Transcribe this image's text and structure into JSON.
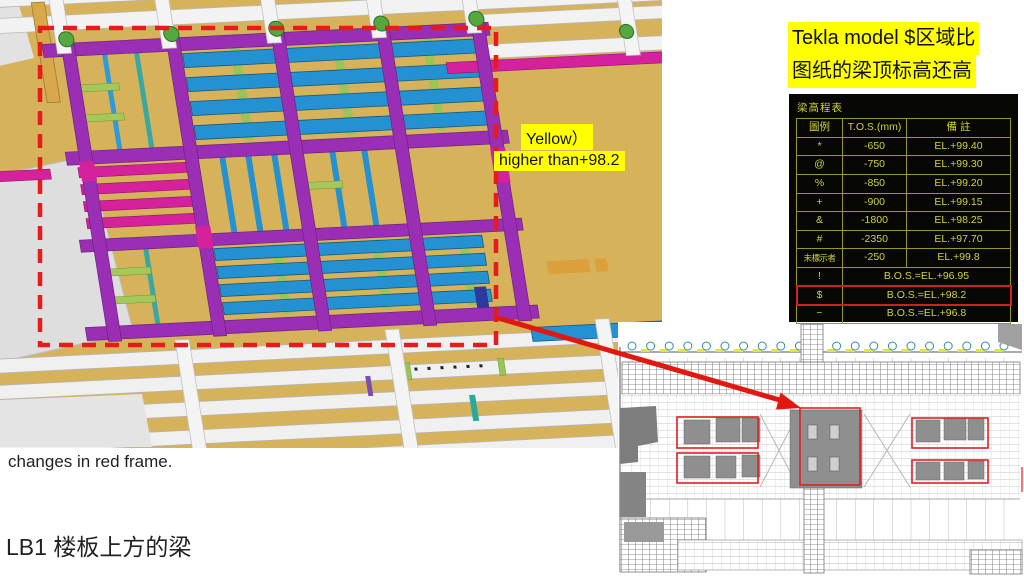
{
  "note": {
    "line1": "Tekla model $区域比",
    "line2": "图纸的梁顶标高还高"
  },
  "model_labels": {
    "yellow_label": "Yellow）",
    "higher_label": "higher than+98.2"
  },
  "elevation_table": {
    "title": "梁高程表",
    "headers": [
      "圖例",
      "T.O.S.(mm)",
      "備 註"
    ],
    "rows": [
      {
        "symbol": "*",
        "tos": "-650",
        "remark": "EL.+99.40"
      },
      {
        "symbol": "@",
        "tos": "-750",
        "remark": "EL.+99.30"
      },
      {
        "symbol": "%",
        "tos": "-850",
        "remark": "EL.+99.20"
      },
      {
        "symbol": "+",
        "tos": "-900",
        "remark": "EL.+99.15"
      },
      {
        "symbol": "&",
        "tos": "-1800",
        "remark": "EL.+98.25"
      },
      {
        "symbol": "#",
        "tos": "-2350",
        "remark": "EL.+97.70"
      },
      {
        "symbol": "未標示者",
        "tos": "-250",
        "remark": "EL.+99.8"
      },
      {
        "symbol": "!",
        "merged": "B.O.S.=EL.+96.95"
      },
      {
        "symbol": "$",
        "merged": "B.O.S.=EL.+98.2",
        "highlight": true
      },
      {
        "symbol": "~",
        "merged": "B.O.S.=EL.+96.8"
      }
    ]
  },
  "captions": {
    "changes": "changes in red frame.",
    "lb1": "LB1 楼板上方的梁"
  },
  "colors": {
    "slab_tan": "#d6b25a",
    "beam_purple": "#9a2fb5",
    "beam_magenta": "#d6219c",
    "beam_blue": "#2492d2",
    "stud_green": "#9cc455",
    "highlight_red": "#e81a1a",
    "table_text": "#d2d23a",
    "label_bg": "#ffff00"
  }
}
